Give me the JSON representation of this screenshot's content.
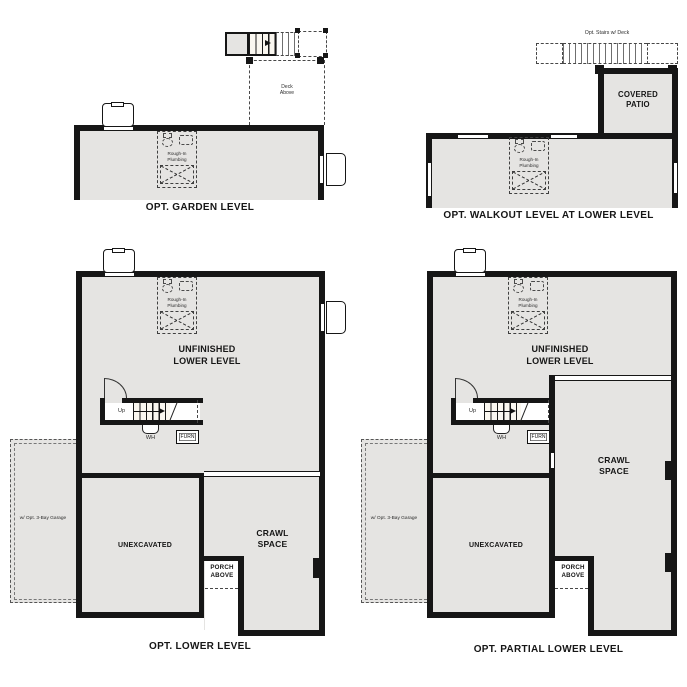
{
  "colors": {
    "room_fill": "#e5e4e2",
    "wall": "#161616",
    "dashed_line": "#474747"
  },
  "plans": {
    "garden": {
      "title": "OPT. GARDEN LEVEL",
      "deck_above": "Deck\nAbove",
      "rough_in": "Rough-In\nPlumbing"
    },
    "walkout": {
      "title": "OPT. WALKOUT LEVEL AT LOWER LEVEL",
      "stairs_note": "Opt. Stairs w/ Deck",
      "covered_patio": "COVERED\nPATIO",
      "rough_in": "Rough-In\nPlumbing"
    },
    "lower": {
      "title": "OPT. LOWER LEVEL",
      "unfinished": "UNFINISHED\nLOWER LEVEL",
      "rough_in": "Rough-In\nPlumbing",
      "up": "Up",
      "wh": "WH",
      "furn": "FURN",
      "unexcavated": "UNEXCAVATED",
      "crawl": "CRAWL\nSPACE",
      "porch": "PORCH\nABOVE",
      "garage_note": "w/ Opt. 3-Bay Garage"
    },
    "partial": {
      "title": "OPT. PARTIAL LOWER LEVEL",
      "unfinished": "UNFINISHED\nLOWER LEVEL",
      "rough_in": "Rough-In\nPlumbing",
      "up": "Up",
      "wh": "WH",
      "furn": "FURN",
      "unexcavated": "UNEXCAVATED",
      "crawl": "CRAWL\nSPACE",
      "porch": "PORCH\nABOVE",
      "garage_note": "w/ Opt. 3-Bay Garage"
    }
  }
}
